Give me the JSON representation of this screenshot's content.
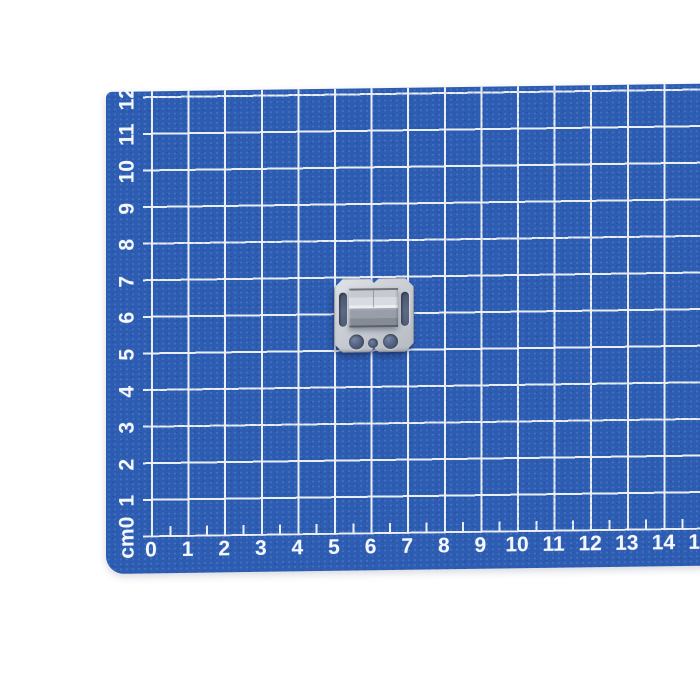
{
  "image": {
    "type": "product-photo",
    "background_color": "#ffffff",
    "subject": "galvanized metal mounting clip lying on a blue self-healing cutting mat with a centimeter grid"
  },
  "mat": {
    "surface_color": "#2d5db3",
    "grid_line_color": "#eaeef5",
    "number_color": "#f4f7fb",
    "unit": "cm",
    "grid_cell_cm": 1,
    "half_cm_ticks_on_bottom_edge": true,
    "bottom_labels": [
      "0",
      "1",
      "2",
      "3",
      "4",
      "5",
      "6",
      "7",
      "8",
      "9",
      "10",
      "11",
      "12",
      "13",
      "14",
      "15"
    ],
    "left_labels": [
      "cm0",
      "1",
      "2",
      "3",
      "4",
      "5",
      "6",
      "7",
      "8",
      "9",
      "10",
      "11",
      "12"
    ]
  },
  "object": {
    "name": "metal mounting clip",
    "approx_size_cm": "2 x 2",
    "plate_color": "#c8ccd2",
    "body_top_color": "#d8dbdf",
    "body_front_color": "#8f959e",
    "slot_count": 2,
    "hole_count": 3
  }
}
